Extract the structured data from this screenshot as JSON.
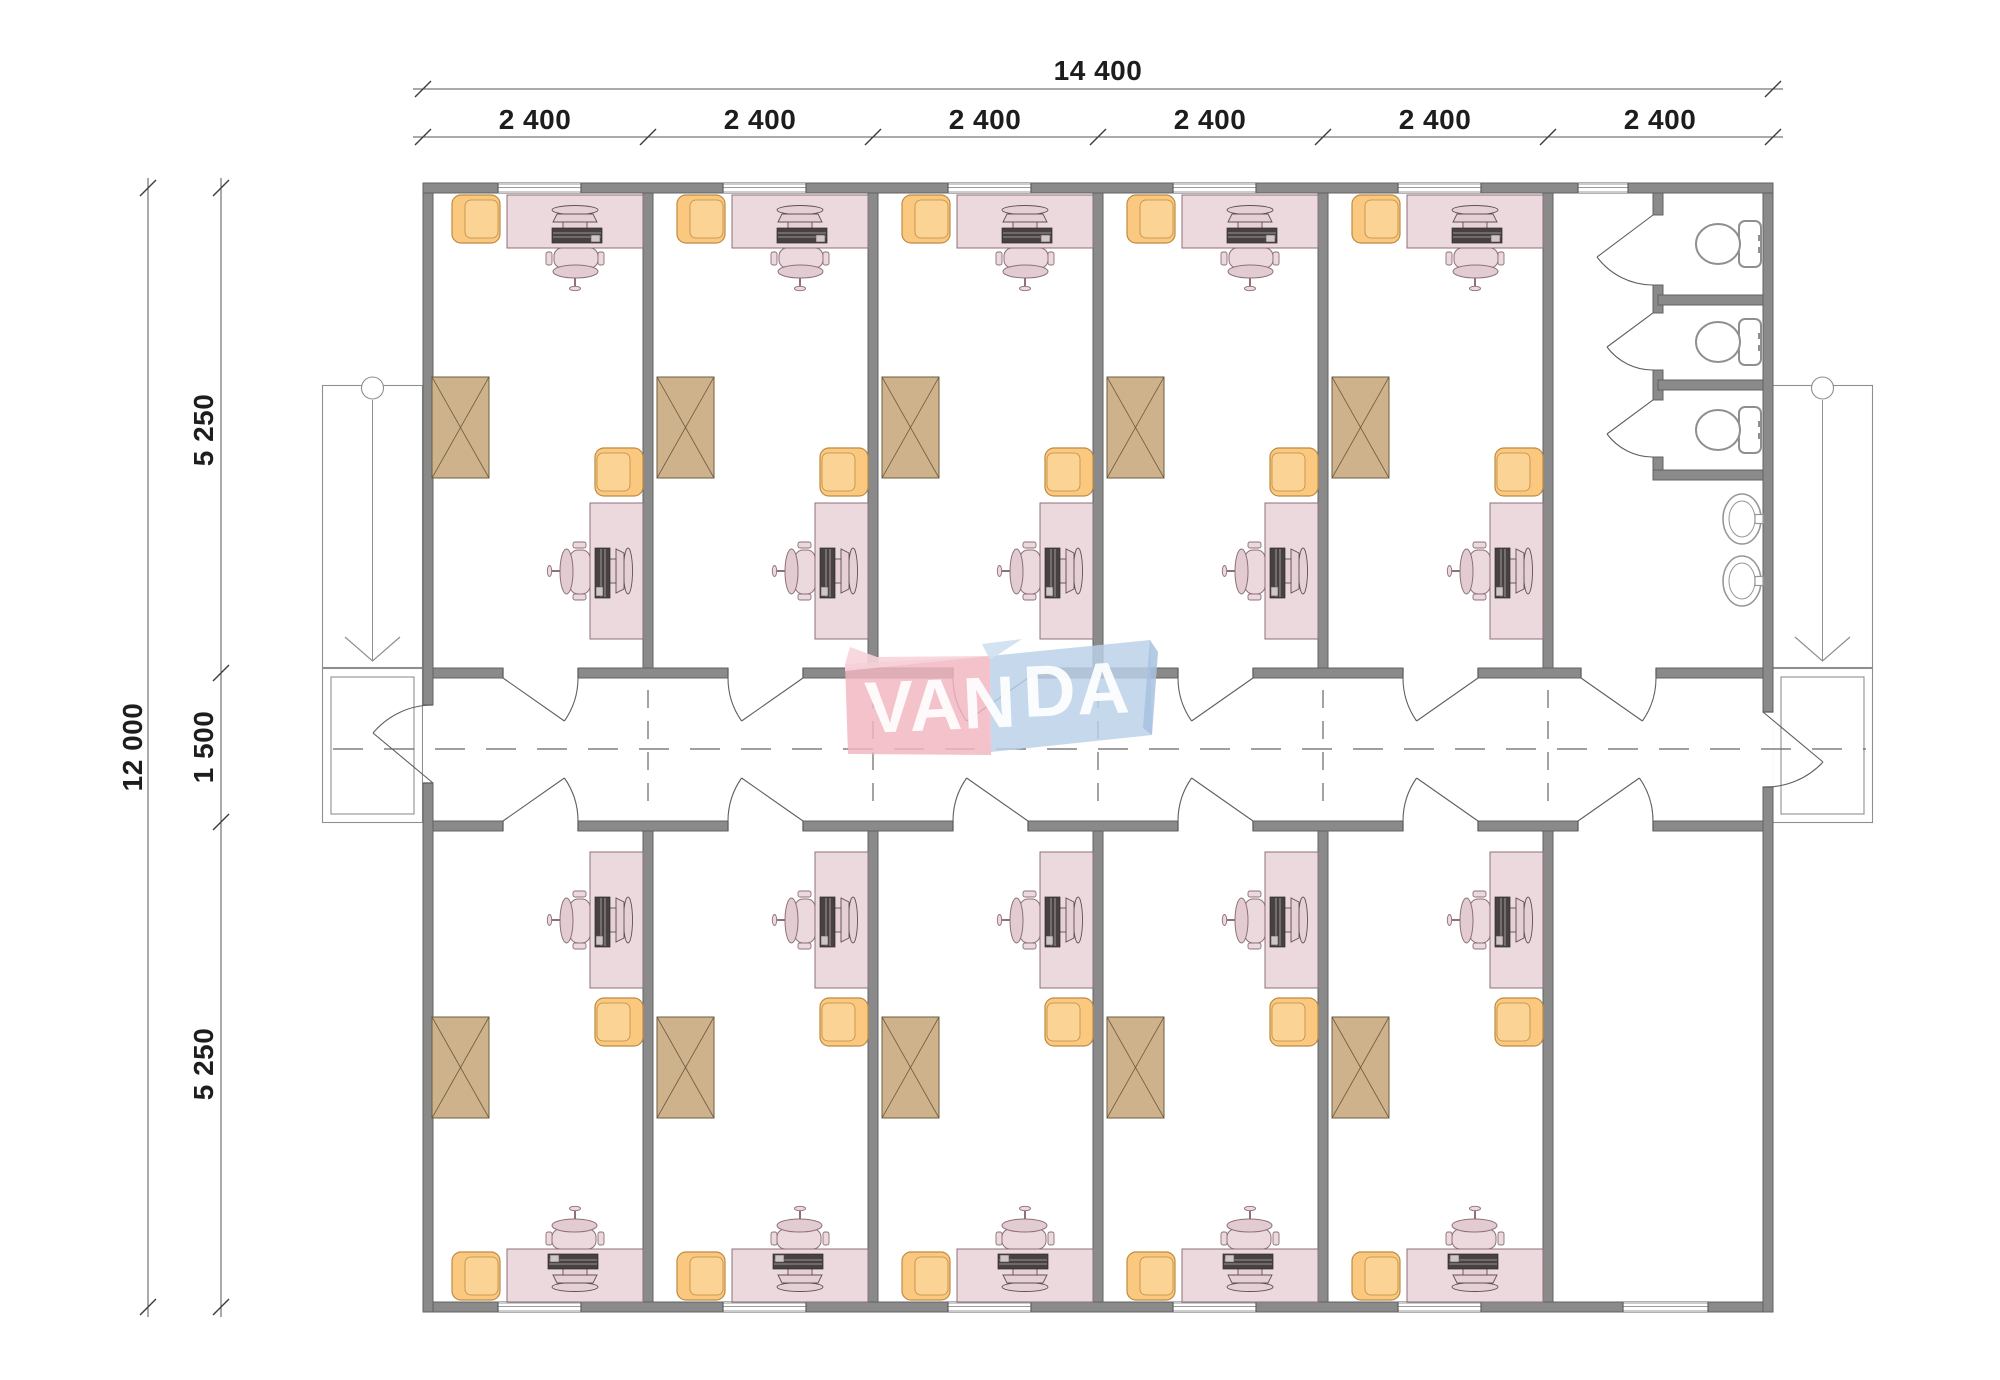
{
  "logo": {
    "text": "VANDA",
    "part_pink": "VAN",
    "part_blue": "DA",
    "pink_color": "#F2B6C1",
    "blue_color": "#B9D0E8"
  },
  "dimensions": {
    "top_total": "14 400",
    "top_segments": [
      "2 400",
      "2 400",
      "2 400",
      "2 400",
      "2 400",
      "2 400"
    ],
    "left_total": "12 000",
    "left_segments": [
      "5 250",
      "1 500",
      "5 250"
    ]
  },
  "plan": {
    "office_rooms_top": 5,
    "office_rooms_bottom": 5,
    "toilet_stalls": 3,
    "sinks": 2,
    "staircases": 2,
    "corridor": 1
  },
  "colors": {
    "wall_gray": "#8A8A8A",
    "furniture_pink": "#ECD9DD",
    "seat_orange": "#FACB80",
    "cabinet_tan": "#CDB28C"
  }
}
